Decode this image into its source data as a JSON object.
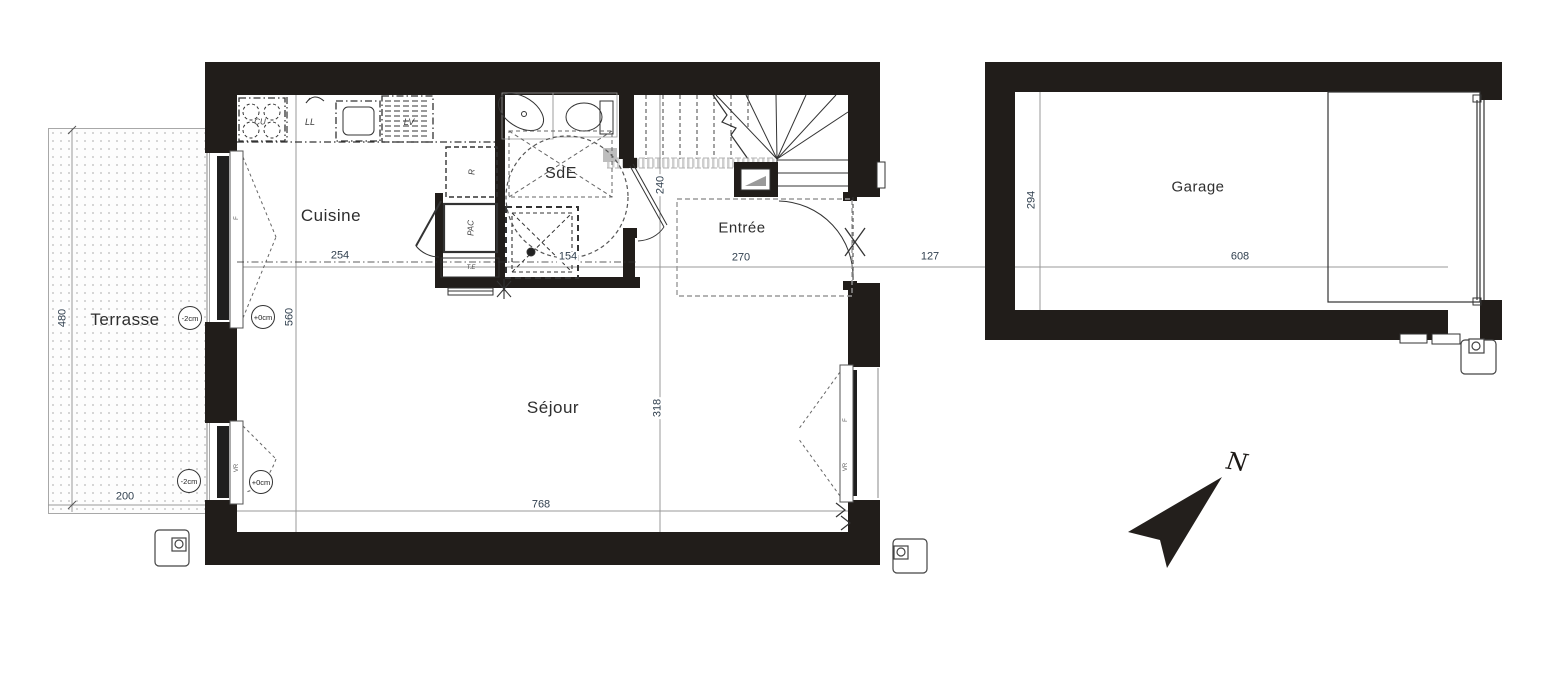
{
  "rooms": {
    "terrasse": "Terrasse",
    "cuisine": "Cuisine",
    "sde": "SdE",
    "entree": "Entrée",
    "sejour": "Séjour",
    "garage": "Garage"
  },
  "dims": {
    "terrace_height": "480",
    "terrace_width": "200",
    "cuisine_width": "254",
    "interior_depth": "560",
    "shower_width": "154",
    "sde_door_height": "240",
    "entree_width": "270",
    "sejour_depth": "318",
    "sejour_width": "768",
    "gap_house_garage": "127",
    "garage_width": "608",
    "garage_depth": "294"
  },
  "levels": {
    "terrace_level": "-2cm",
    "floor_level": "+0cm"
  },
  "appliances": {
    "cooktop": "CU",
    "washer": "LL",
    "dishwasher": "LV",
    "fridge": "R",
    "heat_pump": "PAC",
    "te": "T.E"
  },
  "window_labels": {
    "f": "F",
    "vr": "VR"
  },
  "compass": {
    "north": "N"
  },
  "colors": {
    "wall": "#211d1a",
    "line": "#3a3a3a",
    "dim_line": "#999999",
    "dim_text": "#31404f"
  }
}
